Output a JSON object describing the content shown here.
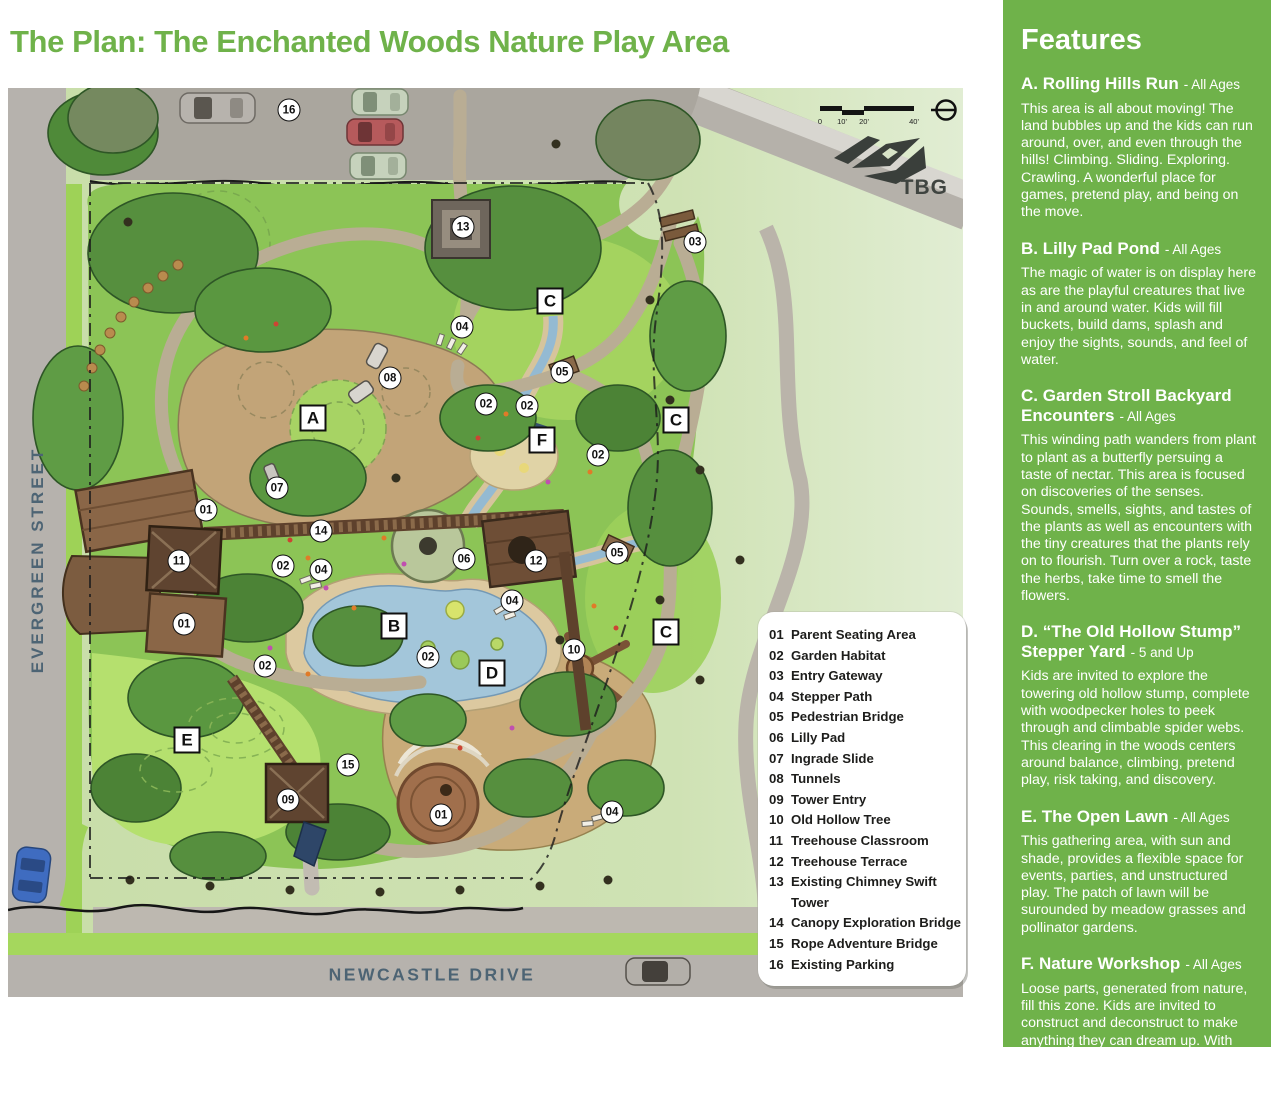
{
  "page": {
    "title": "The Plan: The Enchanted Woods Nature Play Area"
  },
  "map": {
    "streets": {
      "left": "EVERGREEN STREET",
      "bottom": "NEWCASTLE DRIVE"
    },
    "scale": {
      "ticks": [
        "0",
        "10'",
        "20'",
        "40'"
      ]
    },
    "logo": "TBG",
    "legend": {
      "items": [
        {
          "num": "01",
          "label": "Parent Seating Area"
        },
        {
          "num": "02",
          "label": "Garden Habitat"
        },
        {
          "num": "03",
          "label": "Entry Gateway"
        },
        {
          "num": "04",
          "label": "Stepper Path"
        },
        {
          "num": "05",
          "label": "Pedestrian Bridge"
        },
        {
          "num": "06",
          "label": "Lilly Pad"
        },
        {
          "num": "07",
          "label": "Ingrade Slide"
        },
        {
          "num": "08",
          "label": "Tunnels"
        },
        {
          "num": "09",
          "label": "Tower Entry"
        },
        {
          "num": "10",
          "label": "Old Hollow Tree"
        },
        {
          "num": "11",
          "label": "Treehouse Classroom"
        },
        {
          "num": "12",
          "label": "Treehouse Terrace"
        },
        {
          "num": "13",
          "label": "Existing Chimney Swift",
          "label2": "Tower"
        },
        {
          "num": "14",
          "label": "Canopy Exploration Bridge"
        },
        {
          "num": "15",
          "label": "Rope Adventure Bridge"
        },
        {
          "num": "16",
          "label": "Existing Parking"
        }
      ]
    },
    "markers": [
      {
        "n": "16",
        "x": 281,
        "y": 22
      },
      {
        "n": "13",
        "x": 455,
        "y": 139
      },
      {
        "n": "03",
        "x": 687,
        "y": 154
      },
      {
        "n": "04",
        "x": 454,
        "y": 239
      },
      {
        "n": "08",
        "x": 382,
        "y": 290
      },
      {
        "n": "05",
        "x": 554,
        "y": 284
      },
      {
        "n": "02",
        "x": 478,
        "y": 316
      },
      {
        "n": "02",
        "x": 519,
        "y": 318
      },
      {
        "n": "02",
        "x": 590,
        "y": 367
      },
      {
        "n": "07",
        "x": 269,
        "y": 400
      },
      {
        "n": "01",
        "x": 198,
        "y": 422
      },
      {
        "n": "14",
        "x": 313,
        "y": 443
      },
      {
        "n": "11",
        "x": 171,
        "y": 473
      },
      {
        "n": "02",
        "x": 275,
        "y": 478
      },
      {
        "n": "04",
        "x": 313,
        "y": 482
      },
      {
        "n": "06",
        "x": 456,
        "y": 471
      },
      {
        "n": "12",
        "x": 528,
        "y": 473
      },
      {
        "n": "05",
        "x": 609,
        "y": 465
      },
      {
        "n": "04",
        "x": 504,
        "y": 513
      },
      {
        "n": "01",
        "x": 176,
        "y": 536
      },
      {
        "n": "02",
        "x": 257,
        "y": 578
      },
      {
        "n": "02",
        "x": 420,
        "y": 569
      },
      {
        "n": "10",
        "x": 566,
        "y": 562
      },
      {
        "n": "15",
        "x": 340,
        "y": 677
      },
      {
        "n": "09",
        "x": 280,
        "y": 712
      },
      {
        "n": "01",
        "x": 433,
        "y": 727
      },
      {
        "n": "04",
        "x": 604,
        "y": 724
      }
    ],
    "area_labels": [
      {
        "l": "A",
        "x": 305,
        "y": 330
      },
      {
        "l": "C",
        "x": 542,
        "y": 213
      },
      {
        "l": "C",
        "x": 668,
        "y": 332
      },
      {
        "l": "F",
        "x": 534,
        "y": 352
      },
      {
        "l": "B",
        "x": 386,
        "y": 538
      },
      {
        "l": "C",
        "x": 658,
        "y": 544
      },
      {
        "l": "D",
        "x": 484,
        "y": 585
      },
      {
        "l": "E",
        "x": 179,
        "y": 652
      }
    ]
  },
  "sidebar": {
    "accent_color": "#6fb24a",
    "title": "Features",
    "sections": [
      {
        "heading": "A. Rolling Hills Run",
        "ages": "- All Ages",
        "body": "This area is all about moving! The land bubbles up and the kids can run around, over, and even through the hills! Climbing. Sliding. Exploring. Crawling. A wonderful place for games, pretend play, and being on the move."
      },
      {
        "heading": "B. Lilly Pad Pond",
        "ages": "- All Ages",
        "body": "The magic of water is on display here as are the playful creatures that live in and around water. Kids will fill buckets, build dams, splash and enjoy the sights, sounds, and feel of water."
      },
      {
        "heading": "C. Garden Stroll Backyard Encounters",
        "ages": "- All Ages",
        "body": "This winding path wanders from plant to plant as a butterfly persuing a taste of nectar. This area is focused on discoveries of the senses. Sounds, smells, sights, and tastes of the plants as well as encounters with the tiny creatures that the plants rely on to flourish. Turn over a rock, taste the herbs, take time to smell the flowers."
      },
      {
        "heading": "D. “The Old Hollow Stump” Stepper Yard",
        "ages": "- 5 and Up",
        "body": "Kids are invited to explore the towering old hollow stump, complete with woodpecker holes to peek through and climbable spider webs. This clearing in the woods centers around balance, climbing, pretend play, risk taking, and discovery."
      },
      {
        "heading": "E. The Open Lawn",
        "ages": "- All Ages",
        "body": "This gathering area, with sun and shade, provides a flexible space for events, parties, and unstructured play. The patch of lawn will be surounded by meadow grasses and pollinator gardens."
      },
      {
        "heading": "F. Nature Workshop",
        "ages": "- All Ages",
        "body": "Loose parts, generated from nature, fill this zone. Kids are invited to construct and deconstruct to make anything they can dream up. With sand, water, sticks, and mud, kids can dig, pile, move, and make with materials from nature."
      }
    ]
  }
}
